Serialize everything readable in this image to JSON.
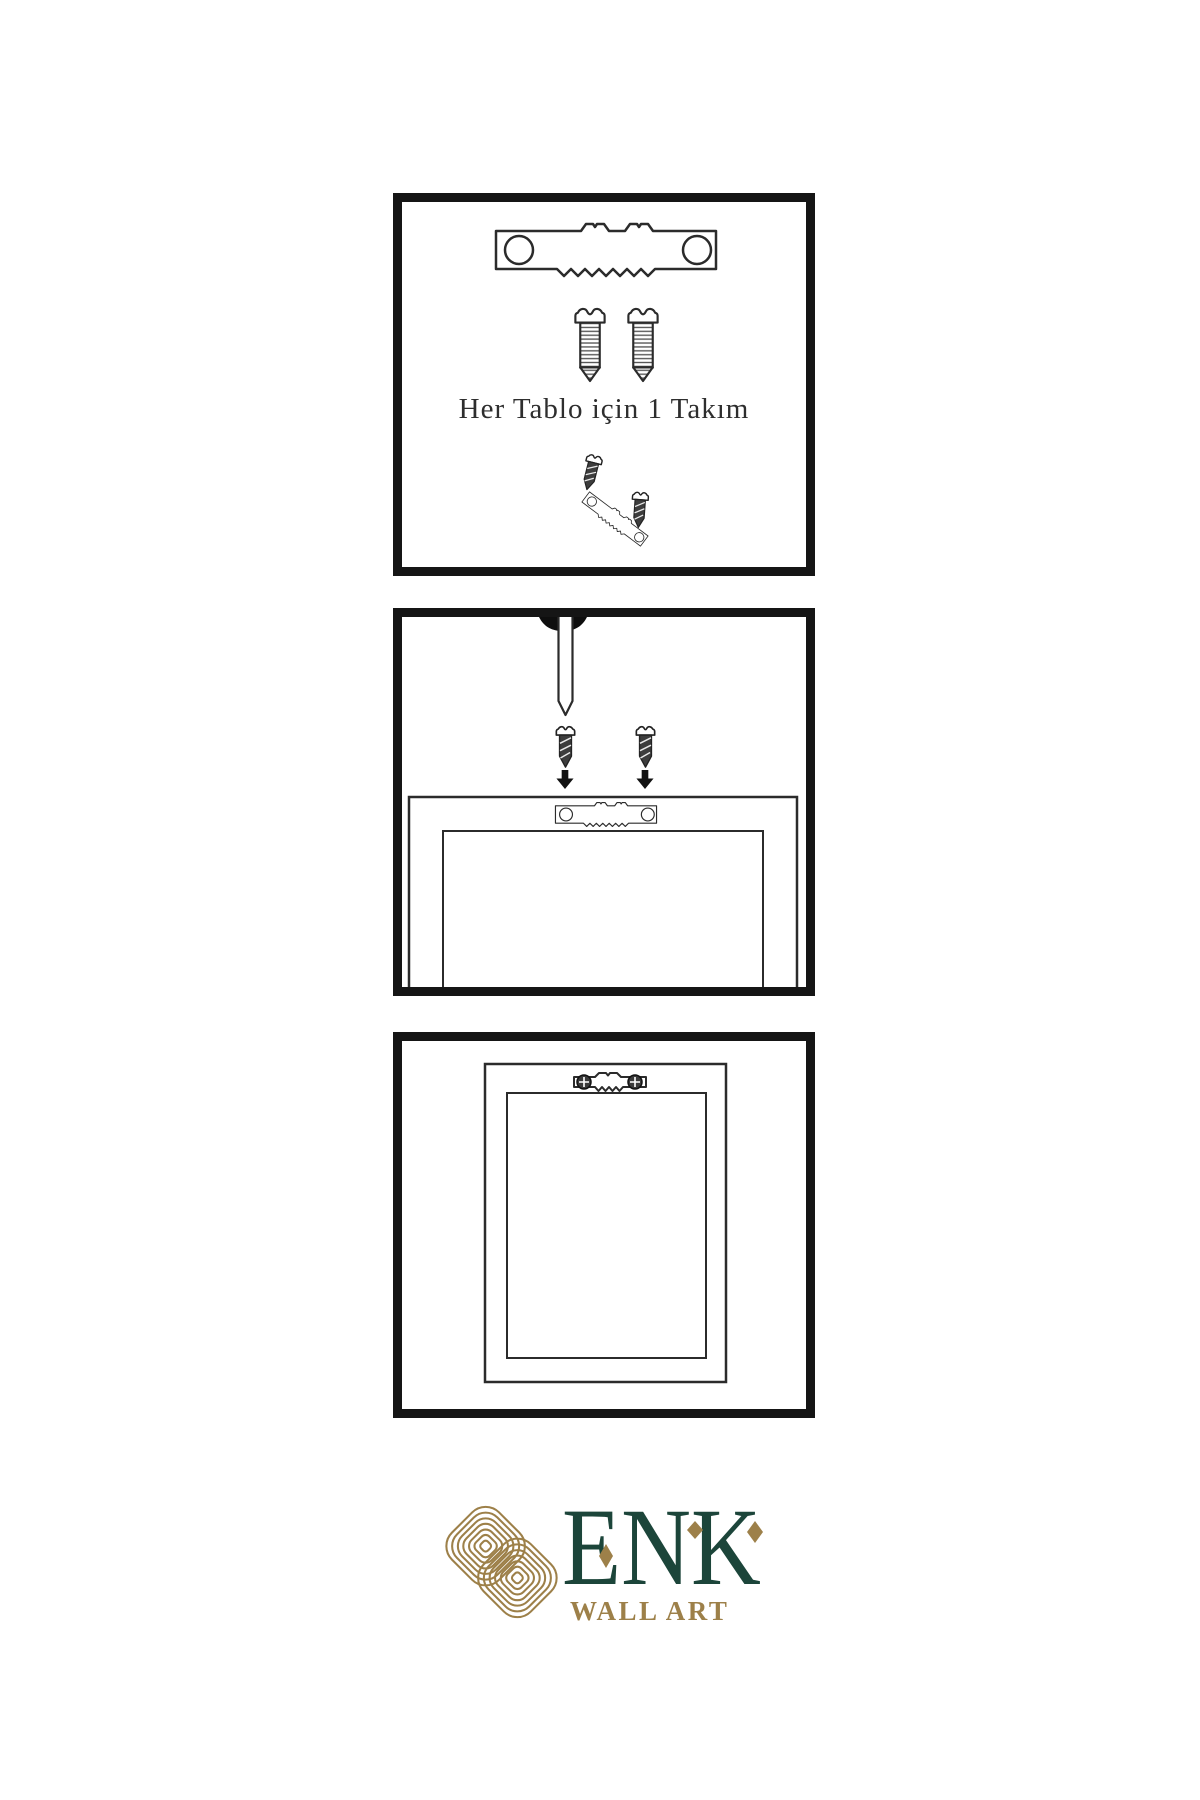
{
  "colors": {
    "background": "#ffffff",
    "line": "#2b2b2b",
    "panel_border": "#151515",
    "screw_dark_fill": "#3d3d3d",
    "nail_head": "#0e0e0e",
    "arrow": "#111111",
    "logo_green": "#1c453a",
    "logo_gold": "#9d8049"
  },
  "panels": {
    "panel1": {
      "caption": "Her Tablo için 1 Takım",
      "items": [
        "sawtooth-hanger",
        "screw",
        "screw",
        "screw-into-hanger-demo"
      ]
    },
    "panel2": {
      "items": [
        "nail-in-wall",
        "screw-with-down-arrow",
        "screw-with-down-arrow",
        "frame-back-with-sawtooth-hanger"
      ]
    },
    "panel3": {
      "items": [
        "hung-frame-back-with-mounted-sawtooth-hanger"
      ]
    }
  },
  "logo": {
    "brand": "ENK",
    "subtitle": "WALL ART"
  }
}
